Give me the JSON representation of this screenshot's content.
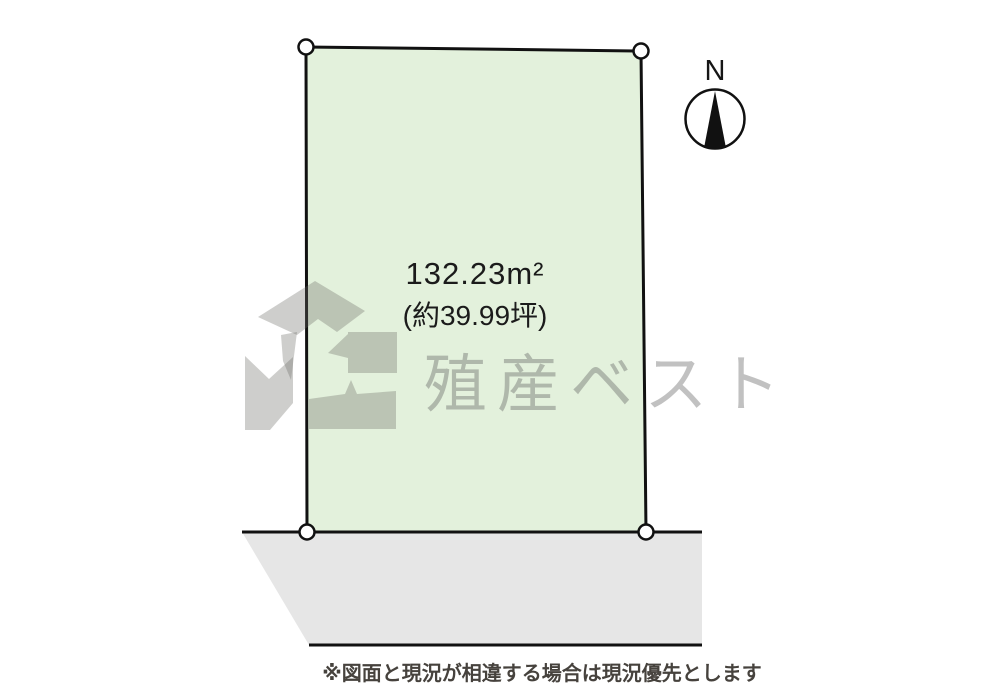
{
  "plot": {
    "area_label_line1": "132.23m²",
    "area_label_line2": "(約39.99坪)",
    "fill_color": "#e3f1dc",
    "outline_color": "#111111"
  },
  "road": {
    "fill_color": "#e6e6e6",
    "edge_color": "#111111"
  },
  "compass": {
    "north_label": "N"
  },
  "watermark": {
    "company_text": "殖産ベスト"
  },
  "footnote": {
    "text": "※図面と現況が相違する場合は現況優先とします"
  }
}
